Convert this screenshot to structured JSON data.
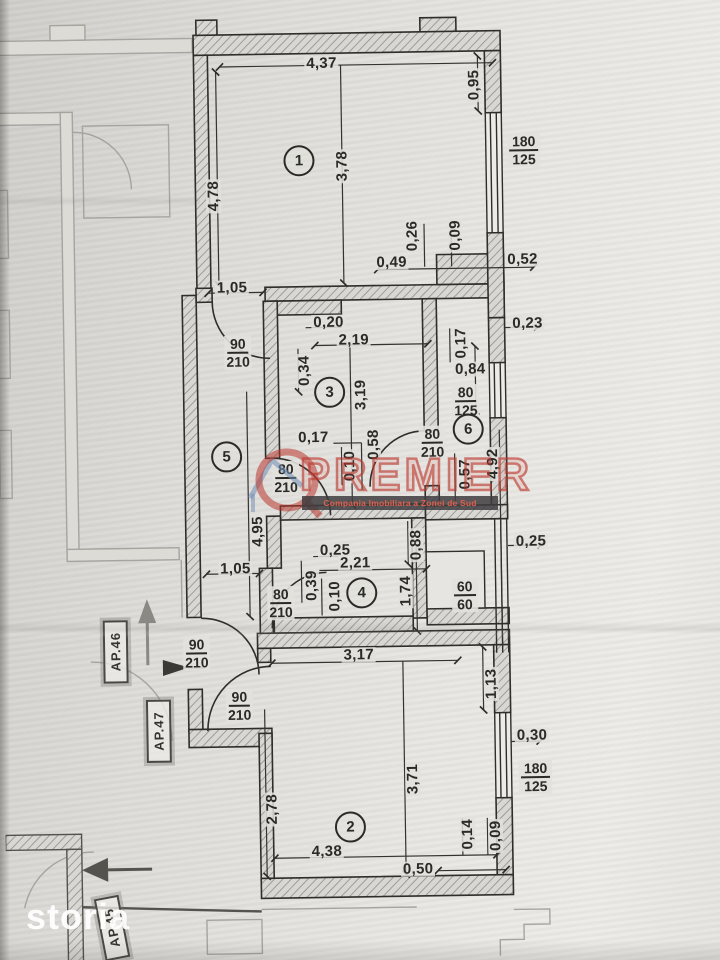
{
  "photo": {
    "paper_color": "#e2e1dd",
    "ink_color": "#2b2a27"
  },
  "watermarks": {
    "storia_label": "storia",
    "premier_title": "PREMIER",
    "premier_tagline": "Compania Imobiliara a Zonei de Sud",
    "premier_color": "#ba372d",
    "logo_house_color": "#6e8cb4"
  },
  "plan": {
    "room_numbers": [
      {
        "n": "1",
        "x": 304,
        "y": 160
      },
      {
        "n": "2",
        "x": 345,
        "y": 827
      },
      {
        "n": "3",
        "x": 331,
        "y": 392
      },
      {
        "n": "4",
        "x": 360,
        "y": 593
      },
      {
        "n": "5",
        "x": 227,
        "y": 455
      },
      {
        "n": "6",
        "x": 469,
        "y": 431
      }
    ],
    "dimensions": [
      {
        "t": "4,37",
        "x": 328,
        "y": 63,
        "r": 0
      },
      {
        "t": "0,95",
        "x": 480,
        "y": 87,
        "r": -90
      },
      {
        "t": "3,78",
        "x": 347,
        "y": 166,
        "r": -90
      },
      {
        "t": "4,78",
        "x": 218,
        "y": 194,
        "r": -90
      },
      {
        "t": "0,26",
        "x": 416,
        "y": 237,
        "r": -90
      },
      {
        "t": "0,09",
        "x": 459,
        "y": 237,
        "r": -90
      },
      {
        "t": "0,49",
        "x": 395,
        "y": 263,
        "r": 0
      },
      {
        "t": "0,52",
        "x": 526,
        "y": 262,
        "r": 0
      },
      {
        "t": "1,05",
        "x": 235,
        "y": 286,
        "r": 0
      },
      {
        "t": "0,20",
        "x": 331,
        "y": 322,
        "r": 0
      },
      {
        "t": "2,19",
        "x": 356,
        "y": 340,
        "r": 0
      },
      {
        "t": "0,34",
        "x": 306,
        "y": 370,
        "r": -90
      },
      {
        "t": "3,19",
        "x": 362,
        "y": 395,
        "r": -90
      },
      {
        "t": "0,23",
        "x": 530,
        "y": 326,
        "r": 0
      },
      {
        "t": "0,17",
        "x": 463,
        "y": 345,
        "r": -90
      },
      {
        "t": "0,84",
        "x": 472,
        "y": 371,
        "r": 0
      },
      {
        "t": "0,17",
        "x": 314,
        "y": 437,
        "r": 0
      },
      {
        "t": "0,58",
        "x": 374,
        "y": 445,
        "r": -90
      },
      {
        "t": "0,10",
        "x": 350,
        "y": 466,
        "r": -90
      },
      {
        "t": "4,92",
        "x": 493,
        "y": 466,
        "r": -90
      },
      {
        "t": "0,57",
        "x": 465,
        "y": 476,
        "r": -90
      },
      {
        "t": "4,95",
        "x": 257,
        "y": 530,
        "r": -90
      },
      {
        "t": "0,25",
        "x": 334,
        "y": 550,
        "r": 0
      },
      {
        "t": "2,21",
        "x": 354,
        "y": 563,
        "r": 0
      },
      {
        "t": "0,39",
        "x": 310,
        "y": 585,
        "r": -90
      },
      {
        "t": "0,10",
        "x": 333,
        "y": 596,
        "r": -90
      },
      {
        "t": "0,88",
        "x": 415,
        "y": 546,
        "r": -90
      },
      {
        "t": "1,74",
        "x": 404,
        "y": 592,
        "r": -90
      },
      {
        "t": "0,25",
        "x": 530,
        "y": 544,
        "r": 0
      },
      {
        "t": "1,05",
        "x": 234,
        "y": 567,
        "r": 0
      },
      {
        "t": "3,17",
        "x": 356,
        "y": 655,
        "r": 0
      },
      {
        "t": "1,13",
        "x": 488,
        "y": 686,
        "r": -90
      },
      {
        "t": "0,30",
        "x": 528,
        "y": 738,
        "r": 0
      },
      {
        "t": "3,71",
        "x": 408,
        "y": 780,
        "r": -90
      },
      {
        "t": "2,78",
        "x": 267,
        "y": 808,
        "r": -90
      },
      {
        "t": "4,38",
        "x": 321,
        "y": 851,
        "r": 0
      },
      {
        "t": "0,14",
        "x": 462,
        "y": 836,
        "r": -90
      },
      {
        "t": "0,09",
        "x": 490,
        "y": 838,
        "r": -90
      },
      {
        "t": "0,50",
        "x": 412,
        "y": 870,
        "r": 0
      }
    ],
    "fractions": [
      {
        "num": "180",
        "den": "125",
        "x": 529,
        "y": 153
      },
      {
        "num": "90",
        "den": "210",
        "x": 240,
        "y": 351
      },
      {
        "num": "80",
        "den": "125",
        "x": 467,
        "y": 403
      },
      {
        "num": "80",
        "den": "210",
        "x": 433,
        "y": 444
      },
      {
        "num": "80",
        "den": "210",
        "x": 286,
        "y": 477
      },
      {
        "num": "60",
        "den": "60",
        "x": 463,
        "y": 597
      },
      {
        "num": "80",
        "den": "210",
        "x": 279,
        "y": 602
      },
      {
        "num": "90",
        "den": "210",
        "x": 194,
        "y": 651
      },
      {
        "num": "90",
        "den": "210",
        "x": 236,
        "y": 704
      },
      {
        "num": "180",
        "den": "125",
        "x": 531,
        "y": 780
      }
    ],
    "apartment_labels": [
      {
        "t": "AP.46",
        "x": 113,
        "y": 648,
        "r": -90
      },
      {
        "t": "AP.47",
        "x": 155,
        "y": 728,
        "r": -90
      },
      {
        "t": "AP.45",
        "x": 105,
        "y": 924,
        "r": -100
      }
    ]
  }
}
